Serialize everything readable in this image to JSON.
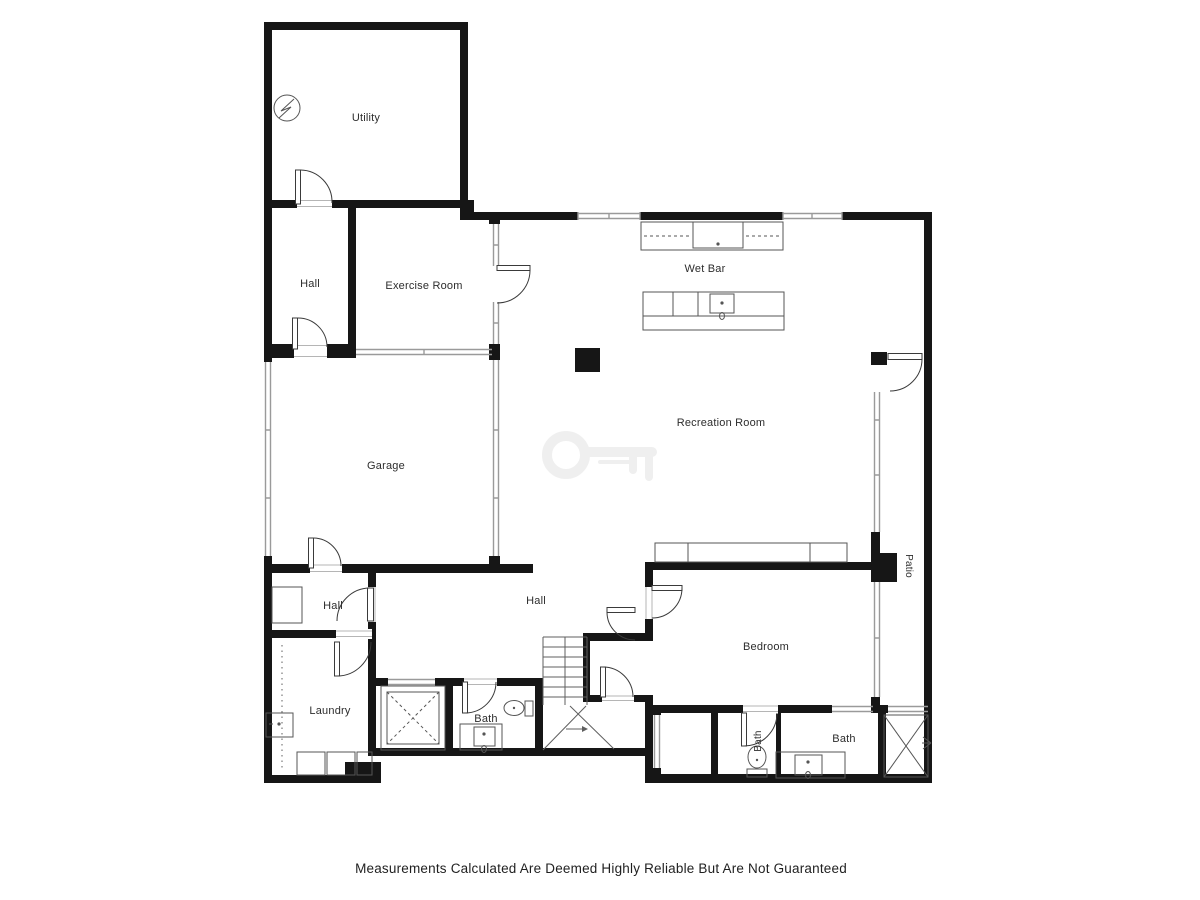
{
  "title": "Basement Floor Plan",
  "disclaimer": "Measurements Calculated Are Deemed Highly Reliable But Are Not Guaranteed",
  "rooms": {
    "utility": "Utility",
    "hall_upper": "Hall",
    "exercise_room": "Exercise Room",
    "wet_bar": "Wet Bar",
    "recreation_room": "Recreation Room",
    "garage": "Garage",
    "hall_mid": "Hall",
    "hall_center": "Hall",
    "bedroom": "Bedroom",
    "laundry": "Laundry",
    "bath_center": "Bath",
    "bath_ensuite_small": "Bath",
    "bath_ensuite": "Bath",
    "patio": "Patio"
  },
  "icons": {
    "electrical_panel": "electrical-panel-icon",
    "watermark": "key-watermark",
    "sink": "sink-icon",
    "toilet": "toilet-icon",
    "shower": "shower-icon",
    "stairs": "stairs-icon"
  },
  "colors": {
    "wall": "#161616",
    "thin_wall": "#9a9a9a",
    "fixture": "#555555",
    "label": "#2d2d2d",
    "watermark": "#ededed",
    "background": "#ffffff"
  }
}
